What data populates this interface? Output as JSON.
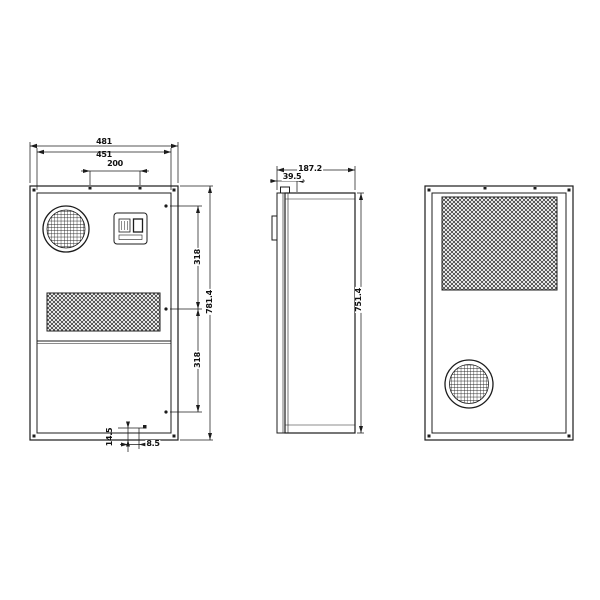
{
  "colors": {
    "line": "#1c1c1c",
    "background": "#ffffff"
  },
  "views": {
    "front": {
      "dims": {
        "flange_width": "481",
        "body_width": "451",
        "top_hole_spacing": "200",
        "right_upper_segment": "318",
        "right_lower_segment": "318",
        "flange_height": "781.4",
        "bottom_offset_vertical": "14.5",
        "bottom_offset_horizontal": "8.5"
      }
    },
    "side": {
      "dims": {
        "depth": "187.2",
        "front_section_depth": "39.5",
        "body_height": "751.4"
      }
    }
  }
}
